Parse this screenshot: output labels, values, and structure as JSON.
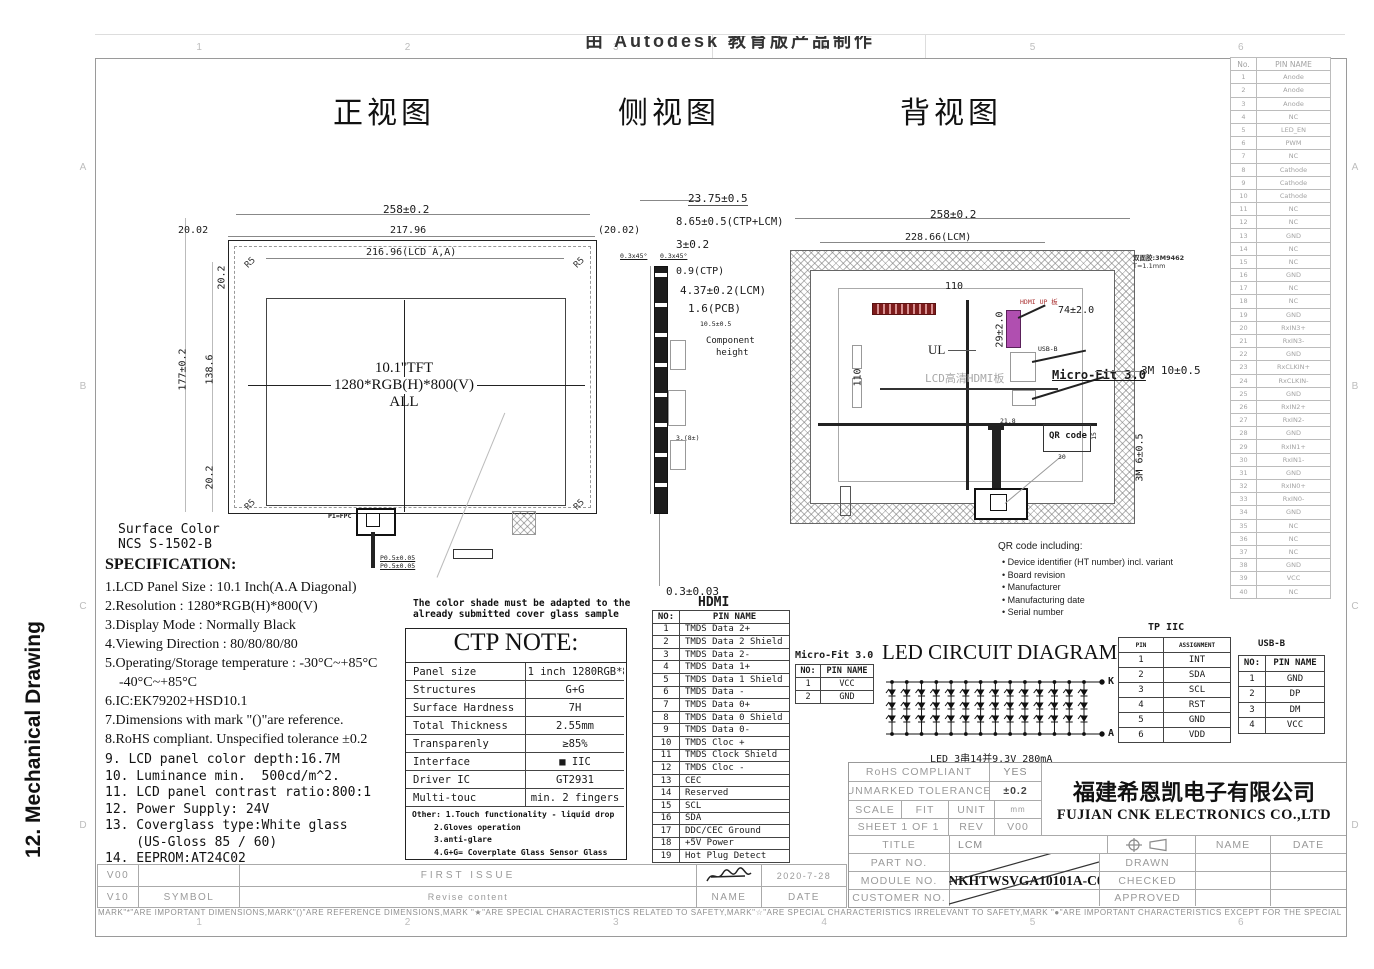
{
  "page_label": "12.  Mechanical Drawing",
  "watermark": "由 Autodesk 教育版产品制作",
  "views": {
    "front": "正视图",
    "side": "侧视图",
    "back": "背视图"
  },
  "frame": {
    "cols": [
      "1",
      "2",
      "3",
      "4",
      "5",
      "6"
    ],
    "rows": [
      "A",
      "B",
      "C",
      "D"
    ]
  },
  "front_view": {
    "d258": "258±0.2",
    "d2002l": "20.02",
    "d21796": "217.96",
    "d2002r": "(20.02)",
    "d21696": "216.96(LCD A,A)",
    "r5": "R5",
    "d202t": "20.2",
    "d177": "177±0.2",
    "d1386": "138.6",
    "d202b": "20.2",
    "center1": "10.1''TFT",
    "center2": "1280*RGB(H)*800(V)",
    "center3": "ALL",
    "surface1": "Surface Color",
    "surface2": "NCS S-1502-B",
    "p1": "P1=FPC",
    "p05a": "P0.5±0.05",
    "p05b": "P0.5±0.05"
  },
  "side_view": {
    "d2375": "23.75±0.5",
    "d865": "8.65±0.5(CTP+LCM)",
    "d3": "3±0.2",
    "d03a": "0.3x45°",
    "d03b": "0.3x45°",
    "d09": "0.9(CTP)",
    "d437": "4.37±0.2(LCM)",
    "d16": "1.6(PCB)",
    "d105": "10.5±0.5",
    "comp1": "Component",
    "comp2": "height",
    "d3b": "3.(8±)",
    "d003": "0.3±0.03"
  },
  "back_view": {
    "d258": "258±0.2",
    "d22866": "228.66(LCM)",
    "d110h": "110",
    "d110v": "110",
    "d29": "29±2.0",
    "d74": "74±2.0",
    "hdmi_lbl": "HDMI UP 板",
    "ul": "UL",
    "board": "LCD高清HDMI板",
    "usb": "USB-B",
    "microfit": "Micro-Fit 3.0",
    "qr": "QR code",
    "d218": "21.8",
    "d15": "15",
    "d30": "30",
    "tape1": "双面胶:3M9462",
    "tape2": "T=1.1mm",
    "d3m10": "3M 10±0.5",
    "d3m6": "3M 6±0.5"
  },
  "qr_note": {
    "title": "QR code including:",
    "items": [
      "Device identifier (HT number) incl. variant",
      "Board revision",
      "Manufacturer",
      "Manufacturing date",
      "Serial number"
    ]
  },
  "spec": {
    "title": "SPECIFICATION:",
    "items_serif": [
      "1.LCD Panel Size : 10.1 Inch(A.A Diagonal)",
      "2.Resolution : 1280*RGB(H)*800(V)",
      "3.Display Mode : Normally Black",
      "4.Viewing Direction : 80/80/80/80",
      "5.Operating/Storage temperature : -30°C~+85°C",
      "    -40°C~+85°C",
      "6.IC:EK79202+HSD10.1",
      "7.Dimensions with mark \"()\"are reference.",
      "8.RoHS compliant. Unspecified tolerance ±0.2"
    ],
    "items_mono": [
      "9. LCD panel color depth:16.7M",
      "10. Luminance min.  500cd/m^2.",
      "11. LCD panel contrast ratio:800:1",
      "12. Power Supply: 24V",
      "13. Coverglass type:White glass",
      "    (US-Gloss 85 / 60)",
      "14. EEPROM:AT24C02"
    ]
  },
  "color_note": {
    "line1": "The color shade must be adapted to the",
    "line2": "already submitted cover glass sample"
  },
  "ctp_note": {
    "title": "CTP NOTE:",
    "rows": [
      [
        "Panel size",
        "10.1 inch 1280RGB*800"
      ],
      [
        "Structures",
        "G+G"
      ],
      [
        "Surface Hardness",
        "7H"
      ],
      [
        "Total Thickness",
        "2.55mm"
      ],
      [
        "Transparenly",
        "≥85%"
      ],
      [
        "Interface",
        "■ IIC"
      ],
      [
        "Driver IC",
        "GT2931"
      ],
      [
        "Multi-touc",
        "min. 2 fingers"
      ]
    ],
    "other": [
      "Other: 1.Touch functionality - liquid drop",
      "2.Gloves operation",
      "3.anti-glare",
      "4.G+G= Coverplate Glass Sensor Glass"
    ]
  },
  "hdmi": {
    "title": "HDMI",
    "rows": [
      [
        "NO:",
        "PIN NAME"
      ],
      [
        "1",
        "TMDS Data 2+"
      ],
      [
        "2",
        "TMDS Data 2 Shield"
      ],
      [
        "3",
        "TMDS Data 2-"
      ],
      [
        "4",
        "TMDS Data 1+"
      ],
      [
        "5",
        "TMDS Data 1 Shield"
      ],
      [
        "6",
        "TMDS Data -"
      ],
      [
        "7",
        "TMDS Data 0+"
      ],
      [
        "8",
        "TMDS Data 0 Shield"
      ],
      [
        "9",
        "TMDS Data 0-"
      ],
      [
        "10",
        "TMDS Cloc +"
      ],
      [
        "11",
        "TMDS Clock Shield"
      ],
      [
        "12",
        "TMDS Cloc -"
      ],
      [
        "13",
        "CEC"
      ],
      [
        "14",
        "Reserved"
      ],
      [
        "15",
        "SCL"
      ],
      [
        "16",
        "SDA"
      ],
      [
        "17",
        "DDC/CEC Ground"
      ],
      [
        "18",
        "+5V Power"
      ],
      [
        "19",
        "Hot Plug Detect"
      ]
    ]
  },
  "microfit": {
    "title": "Micro-Fit 3.0",
    "rows": [
      [
        "NO:",
        "PIN NAME"
      ],
      [
        "1",
        "VCC"
      ],
      [
        "2",
        "GND"
      ]
    ]
  },
  "led": {
    "title": "LED CIRCUIT DIAGRAM:",
    "cathode": "K",
    "anode": "A",
    "caption": "LED 3串14并9.3V 280mA",
    "series": 3,
    "parallel": 14
  },
  "tp_iic": {
    "title": "TP IIC",
    "rows": [
      [
        "PIN",
        "ASSIGNMENT"
      ],
      [
        "1",
        "INT"
      ],
      [
        "2",
        "SDA"
      ],
      [
        "3",
        "SCL"
      ],
      [
        "4",
        "RST"
      ],
      [
        "5",
        "GND"
      ],
      [
        "6",
        "VDD"
      ]
    ]
  },
  "usb": {
    "title": "USB-B",
    "rows": [
      [
        "NO:",
        "PIN NAME"
      ],
      [
        "1",
        "GND"
      ],
      [
        "2",
        "DP"
      ],
      [
        "3",
        "DM"
      ],
      [
        "4",
        "VCC"
      ]
    ]
  },
  "backlight_pins": {
    "rows": [
      [
        "No.",
        "PIN NAME"
      ],
      [
        "1",
        "Anode"
      ],
      [
        "2",
        "Anode"
      ],
      [
        "3",
        "Anode"
      ],
      [
        "4",
        "NC"
      ],
      [
        "5",
        "LED_EN"
      ],
      [
        "6",
        "PWM"
      ],
      [
        "7",
        "NC"
      ],
      [
        "8",
        "Cathode"
      ],
      [
        "9",
        "Cathode"
      ],
      [
        "10",
        "Cathode"
      ],
      [
        "11",
        "NC"
      ],
      [
        "12",
        "NC"
      ],
      [
        "13",
        "GND"
      ],
      [
        "14",
        "NC"
      ],
      [
        "15",
        "NC"
      ],
      [
        "16",
        "GND"
      ],
      [
        "17",
        "NC"
      ],
      [
        "18",
        "NC"
      ],
      [
        "19",
        "GND"
      ],
      [
        "20",
        "RxIN3+"
      ],
      [
        "21",
        "RxIN3-"
      ],
      [
        "22",
        "GND"
      ],
      [
        "23",
        "RxCLKIN+"
      ],
      [
        "24",
        "RxCLKIN-"
      ],
      [
        "25",
        "GND"
      ],
      [
        "26",
        "RxIN2+"
      ],
      [
        "27",
        "RxIN2-"
      ],
      [
        "28",
        "GND"
      ],
      [
        "29",
        "RxIN1+"
      ],
      [
        "30",
        "RxIN1-"
      ],
      [
        "31",
        "GND"
      ],
      [
        "32",
        "RxIN0+"
      ],
      [
        "33",
        "RxIN0-"
      ],
      [
        "34",
        "GND"
      ],
      [
        "35",
        "NC"
      ],
      [
        "36",
        "NC"
      ],
      [
        "37",
        "NC"
      ],
      [
        "38",
        "GND"
      ],
      [
        "39",
        "VCC"
      ],
      [
        "40",
        "NC"
      ]
    ]
  },
  "title_block": {
    "rohs_label": "RoHS COMPLIANT",
    "rohs_value": "YES",
    "tol_label": "UNMARKED TOLERANCE",
    "tol_value": "±0.2",
    "scale_label": "SCALE",
    "scale_value": "FIT",
    "unit_label": "UNIT",
    "unit_value": "mm",
    "sheet_label": "SHEET 1 OF 1",
    "rev_label": "REV",
    "rev_value": "V00",
    "company_cn": "福建希恩凯电子有限公司",
    "company_en": "FUJIAN CNK ELECTRONICS CO.,LTD",
    "title_label": "TITLE",
    "title_value": "LCM",
    "part_label": "PART NO.",
    "module_label": "MODULE NO.",
    "module_value": "CNKHTWSVGA10101A-C02",
    "customer_label": "CUSTOMER NO.",
    "name_label": "NAME",
    "date_label": "DATE",
    "drawn_label": "DRAWN",
    "checked_label": "CHECKED",
    "approved_label": "APPROVED"
  },
  "revisions": {
    "r1_ver": "V00",
    "r1_desc": "FIRST ISSUE",
    "r1_date": "2020-7-28",
    "r2_ver": "V10",
    "r2_sym": "SYMBOL",
    "r2_desc": "Revise content",
    "r2_name": "NAME",
    "r2_date": "DATE"
  },
  "bottom_note": "MARK\"*\"ARE IMPORTANT DIMENSIONS,MARK\"()\"ARE REFERENCE DIMENSIONS,MARK \"★\"ARE SPECIAL CHARACTERISTICS RELATED TO SAFETY,MARK\"☆\"ARE SPECIAL CHARACTERISTICS IRRELEVANT TO SAFETY,MARK \"●\"ARE IMPORTANT CHARACTERISTICS EXCEPT FOR THE SPECIAL CHARACTERISTICS."
}
